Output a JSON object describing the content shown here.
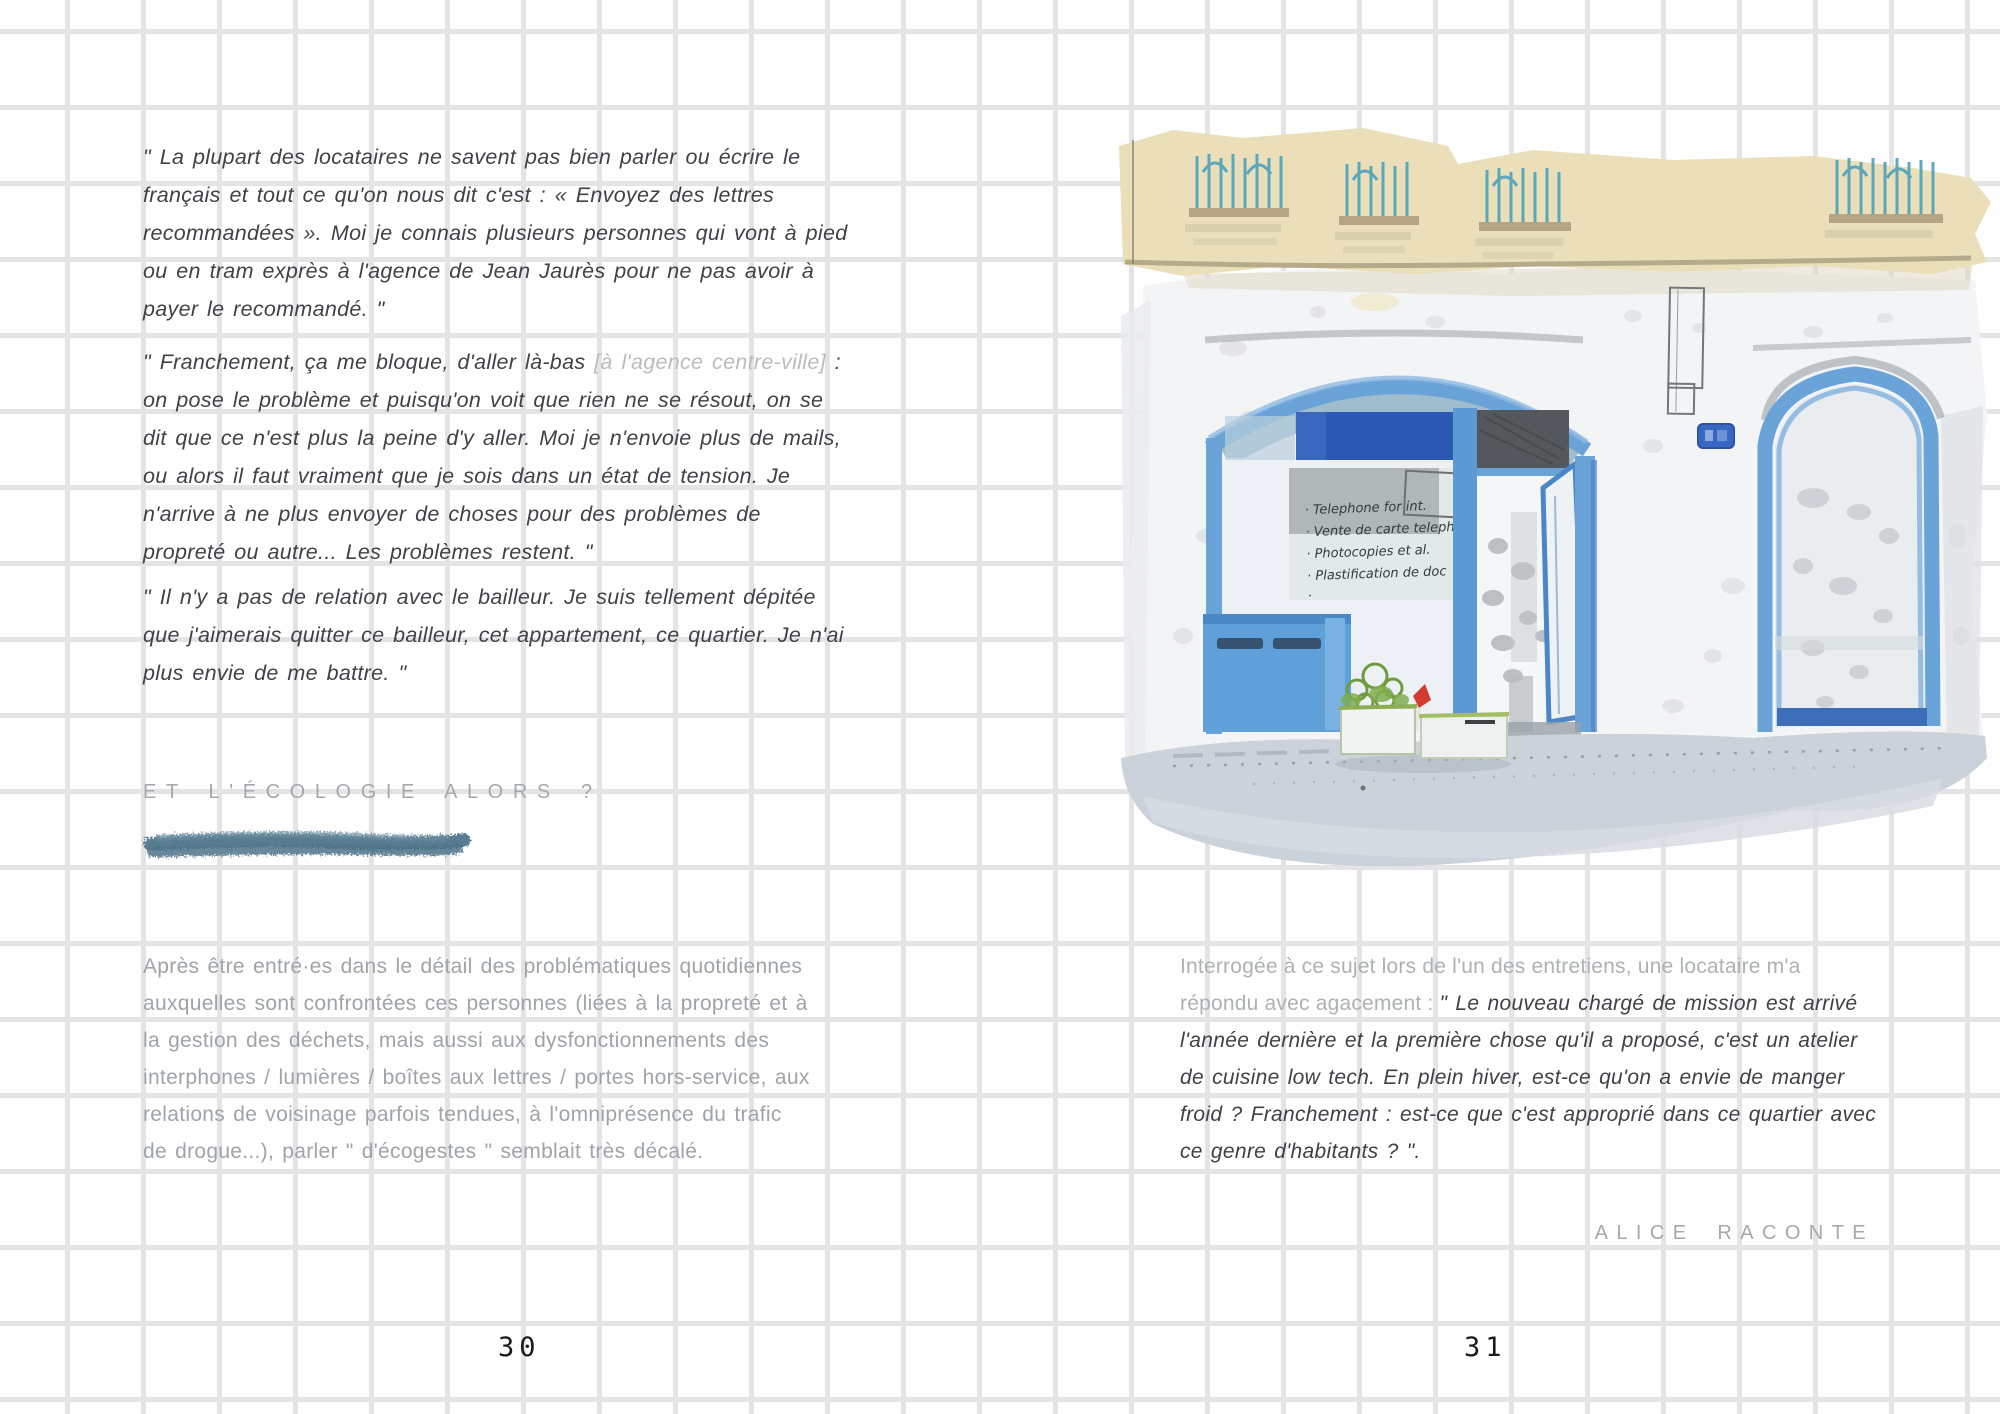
{
  "left_page": {
    "quote1": "\" La plupart des locataires ne savent pas bien parler ou écrire le français et tout ce qu'on nous dit c'est : « Envoyez des lettres recommandées ». Moi je connais plusieurs personnes qui vont à pied ou en tram exprès à l'agence de Jean Jaurès pour ne pas avoir à payer le recommandé. \"",
    "quote2_part1": "\" Franchement, ça me bloque, d'aller là-bas ",
    "quote2_bracket": "[à l'agence centre-ville]",
    "quote2_part2": " : on pose le problème et puisqu'on voit que rien ne se résout, on se dit que ce n'est plus la peine d'y aller. Moi je n'envoie plus de mails, ou alors il faut vraiment que je sois dans un état de tension. Je n'arrive à ne plus envoyer de choses pour des problèmes de propreté ou autre... Les problèmes restent. \"",
    "quote3": "\" Il n'y a pas de relation avec le bailleur. Je suis tellement dépitée que j'aimerais quitter ce bailleur, cet appartement, ce quartier. Je n'ai plus envie de me battre. \"",
    "heading": "ET L'ÉCOLOGIE ALORS ?",
    "paragraph": "Après être entré·es dans le détail des problématiques quotidiennes auxquelles sont confrontées ces personnes (liées à la propreté et à la gestion des déchets, mais aussi aux dysfonctionnements des interphones / lumières / boîtes aux lettres / portes hors-service, aux relations de voisinage parfois tendues, à l'omniprésence du trafic de drogue...), parler \" d'écogestes \" semblait très décalé.",
    "page_number": "30"
  },
  "right_page": {
    "paragraph_intro": "Interrogée à ce sujet lors de l'un des entretiens, une locataire m'a répondu avec agacement : ",
    "paragraph_quote": "\" Le nouveau chargé de mission est arrivé l'année dernière et la première chose qu'il a proposé, c'est un atelier de cuisine low tech. En plein hiver, est-ce qu'on a envie de manger froid ? Franchement : est-ce que c'est approprié dans ce quartier avec ce genre d'habitants ? \".",
    "signature": "ALICE RACONTE",
    "page_number": "31"
  },
  "illustration": {
    "description": "watercolour storefront with blue frames",
    "sign_lines": [
      "· Telephone for int.",
      "· Vente de carte teleph.",
      "· Photocopies et al.",
      "· Plastification de doc",
      "·"
    ]
  },
  "colors": {
    "text_dark": "#3f4246",
    "text_light": "#9fa4a8",
    "heading_gray": "#a4a9ac",
    "scribble_blue": "#597c92",
    "facade_beige": "#eadfb8",
    "frame_blue": "#6aa3d8",
    "banner_blue": "#2b58b2",
    "grille_teal": "#4fa2bc",
    "sidewalk_gray": "#cbd2da"
  }
}
